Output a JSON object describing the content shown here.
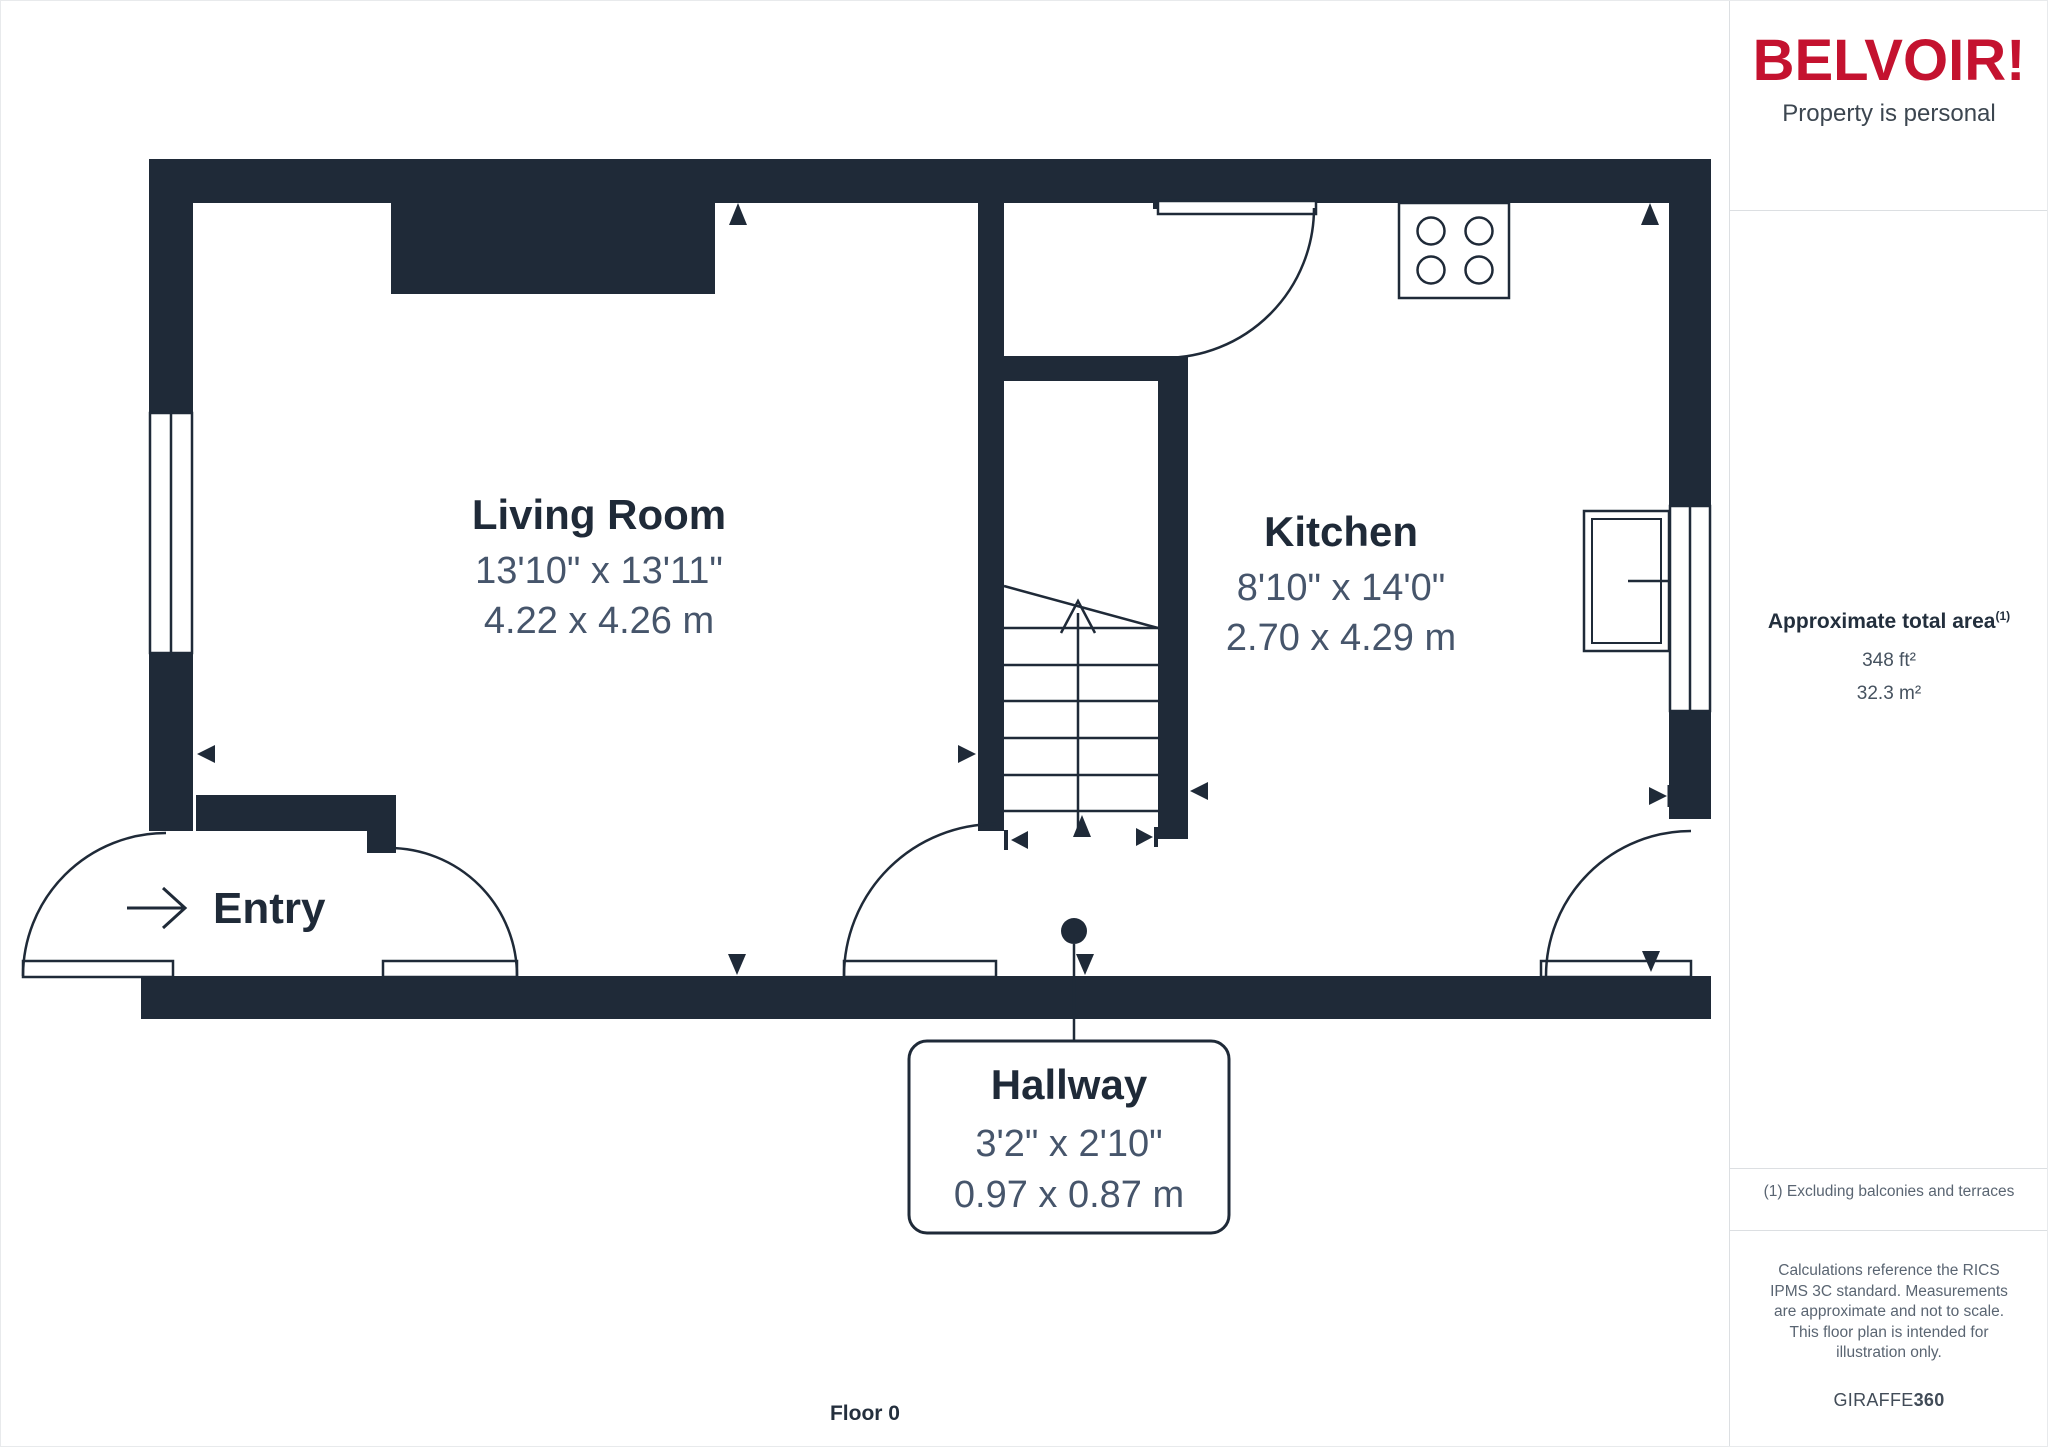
{
  "brand": {
    "logo": "BELVOIR!",
    "tagline": "Property is personal"
  },
  "floor_label": "Floor 0",
  "entry_label": "Entry",
  "rooms": {
    "living": {
      "name": "Living Room",
      "imperial": "13'10\" x 13'11\"",
      "metric": "4.22 x 4.26 m"
    },
    "kitchen": {
      "name": "Kitchen",
      "imperial": "8'10\" x 14'0\"",
      "metric": "2.70 x 4.29 m"
    },
    "hallway": {
      "name": "Hallway",
      "imperial": "3'2\" x 2'10\"",
      "metric": "0.97 x 0.87 m"
    }
  },
  "sidebar": {
    "area_title": "Approximate total area",
    "area_footnote_marker": "(1)",
    "area_imperial": "348 ft²",
    "area_metric": "32.3 m²",
    "footnote": "(1) Excluding balconies and terraces",
    "disclaimer": "Calculations reference the RICS IPMS 3C standard. Measurements are approximate and not to scale. This floor plan is intended for illustration only.",
    "watermark_name": "GIRAFFE",
    "watermark_suffix": "360"
  },
  "colors": {
    "wall": "#1F2A38",
    "brand_red": "#C4122F",
    "room_title_text": "#1F2A38",
    "dimension_text": "#46556B",
    "note_text": "#5A6572",
    "divider": "#DCDFE2"
  }
}
